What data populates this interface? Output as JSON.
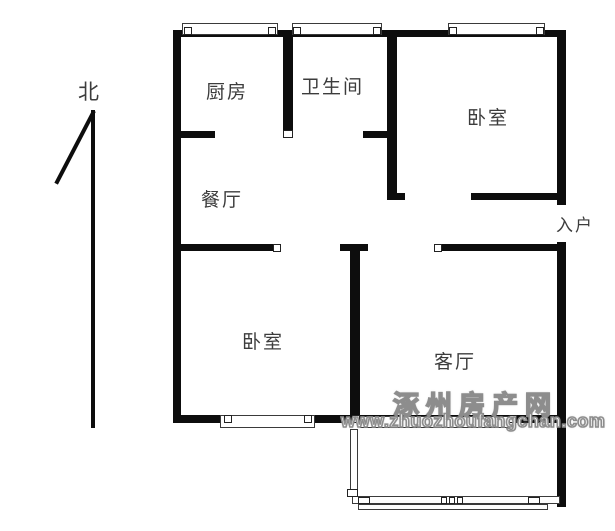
{
  "title": "apartment-floorplan",
  "colors": {
    "background": "#ffffff",
    "wall": "#0d0d0d",
    "label": "#3c3c3c",
    "window_border": "#3a3a3a",
    "cap_border": "#222222",
    "watermark_fill": "#f8f8f8",
    "watermark_stroke": "#8d8d8d"
  },
  "compass": {
    "label": "北"
  },
  "watermark": {
    "line1": "涿州房产网",
    "line2": "www.zhuozhoufangchan.com"
  },
  "rooms": [
    {
      "name": "label-north",
      "text": "北",
      "x": 78,
      "y": 76,
      "size": 21
    },
    {
      "name": "label-kitchen",
      "text": "厨房",
      "x": 206,
      "y": 77,
      "size": 19
    },
    {
      "name": "label-bathroom",
      "text": "卫生间",
      "x": 301,
      "y": 72,
      "size": 19
    },
    {
      "name": "label-bedroom-1",
      "text": "卧室",
      "x": 467,
      "y": 103,
      "size": 19
    },
    {
      "name": "label-dining",
      "text": "餐厅",
      "x": 201,
      "y": 185,
      "size": 19
    },
    {
      "name": "label-entry",
      "text": "入户",
      "x": 556,
      "y": 211,
      "size": 17
    },
    {
      "name": "label-bedroom-2",
      "text": "卧室",
      "x": 242,
      "y": 327,
      "size": 19
    },
    {
      "name": "label-living",
      "text": "客厅",
      "x": 434,
      "y": 347,
      "size": 19
    }
  ],
  "plan": {
    "walls": [
      {
        "name": "top-wall",
        "x": 173,
        "y": 30,
        "w": 393,
        "h": 7
      },
      {
        "name": "left-wall",
        "x": 173,
        "y": 30,
        "w": 8,
        "h": 393
      },
      {
        "name": "right-wall-upper",
        "x": 557,
        "y": 30,
        "w": 9,
        "h": 175
      },
      {
        "name": "right-wall-lower",
        "x": 557,
        "y": 242,
        "w": 9,
        "h": 265
      },
      {
        "name": "kitchen-bath-divider",
        "x": 283,
        "y": 30,
        "w": 10,
        "h": 100
      },
      {
        "name": "bath-bedroom1-wall",
        "x": 387,
        "y": 30,
        "w": 10,
        "h": 170
      },
      {
        "name": "bedroom1-door-foot",
        "x": 387,
        "y": 193,
        "w": 18,
        "h": 7
      },
      {
        "name": "kitchen-door-stub",
        "x": 173,
        "y": 131,
        "w": 42,
        "h": 7
      },
      {
        "name": "bath-door-stub",
        "x": 363,
        "y": 131,
        "w": 24,
        "h": 7
      },
      {
        "name": "bedroom1-bottom-wall",
        "x": 471,
        "y": 193,
        "w": 95,
        "h": 7
      },
      {
        "name": "mid-wall-left",
        "x": 173,
        "y": 244,
        "w": 100,
        "h": 7
      },
      {
        "name": "mid-wall-t",
        "x": 340,
        "y": 244,
        "w": 28,
        "h": 7
      },
      {
        "name": "mid-wall-right",
        "x": 442,
        "y": 244,
        "w": 124,
        "h": 7
      },
      {
        "name": "bedroom2-living-divider",
        "x": 350,
        "y": 251,
        "w": 10,
        "h": 167
      },
      {
        "name": "bottom-wall",
        "x": 173,
        "y": 415,
        "w": 393,
        "h": 8
      },
      {
        "name": "north-arrow-shaft",
        "x": 91,
        "y": 110,
        "w": 4,
        "h": 318
      },
      {
        "name": "north-arrow-tip",
        "x": 92,
        "y": 111,
        "w": 4,
        "h": 82,
        "r": 27.5
      }
    ],
    "windows": [
      {
        "name": "kitchen-window",
        "x": 182,
        "y": 23,
        "w": 96,
        "h": 12
      },
      {
        "name": "bathroom-window",
        "x": 292,
        "y": 23,
        "w": 90,
        "h": 12
      },
      {
        "name": "bedroom1-window",
        "x": 448,
        "y": 23,
        "w": 97,
        "h": 12
      },
      {
        "name": "bedroom2-window",
        "x": 220,
        "y": 415,
        "w": 95,
        "h": 13
      },
      {
        "name": "balcony-door-window",
        "x": 360,
        "y": 416,
        "w": 150,
        "h": 12
      },
      {
        "name": "balcony-left-wall",
        "x": 350,
        "y": 429,
        "w": 8,
        "h": 62
      },
      {
        "name": "balcony-rail-outer",
        "x": 352,
        "y": 496,
        "w": 208,
        "h": 8
      },
      {
        "name": "balcony-rail-inner",
        "x": 358,
        "y": 504,
        "w": 190,
        "h": 6
      }
    ],
    "caps": [
      {
        "name": "kitchen-bath-divider-cap",
        "x": 283,
        "y": 130,
        "w": 10,
        "h": 8
      },
      {
        "name": "mid-wall-left-cap",
        "x": 273,
        "y": 244,
        "w": 8,
        "h": 8
      },
      {
        "name": "mid-wall-right-cap",
        "x": 434,
        "y": 244,
        "w": 8,
        "h": 8
      },
      {
        "name": "kitchen-window-cap-l",
        "x": 184,
        "y": 27,
        "w": 8,
        "h": 8
      },
      {
        "name": "kitchen-window-cap-r",
        "x": 268,
        "y": 27,
        "w": 8,
        "h": 8
      },
      {
        "name": "bathroom-window-cap-l",
        "x": 293,
        "y": 27,
        "w": 8,
        "h": 8
      },
      {
        "name": "bathroom-window-cap-r",
        "x": 373,
        "y": 27,
        "w": 8,
        "h": 8
      },
      {
        "name": "bedroom1-window-cap-l",
        "x": 449,
        "y": 27,
        "w": 8,
        "h": 8
      },
      {
        "name": "bedroom1-window-cap-r",
        "x": 536,
        "y": 27,
        "w": 8,
        "h": 8
      },
      {
        "name": "bedroom2-window-cap-l",
        "x": 224,
        "y": 415,
        "w": 8,
        "h": 8
      },
      {
        "name": "bedroom2-window-cap-r",
        "x": 304,
        "y": 415,
        "w": 8,
        "h": 8
      },
      {
        "name": "balcony-door-cap-l",
        "x": 352,
        "y": 415,
        "w": 8,
        "h": 8
      },
      {
        "name": "balcony-door-cap-r",
        "x": 509,
        "y": 415,
        "w": 8,
        "h": 8
      },
      {
        "name": "balcony-left-wall-cap",
        "x": 347,
        "y": 489,
        "w": 11,
        "h": 8
      },
      {
        "name": "balcony-rail-post-1",
        "x": 358,
        "y": 497,
        "w": 12,
        "h": 7
      },
      {
        "name": "balcony-rail-post-2",
        "x": 441,
        "y": 497,
        "w": 6,
        "h": 7
      },
      {
        "name": "balcony-rail-post-3",
        "x": 449,
        "y": 497,
        "w": 6,
        "h": 7
      },
      {
        "name": "balcony-rail-post-4",
        "x": 457,
        "y": 497,
        "w": 6,
        "h": 7
      },
      {
        "name": "balcony-rail-post-5",
        "x": 528,
        "y": 497,
        "w": 12,
        "h": 7
      }
    ]
  }
}
